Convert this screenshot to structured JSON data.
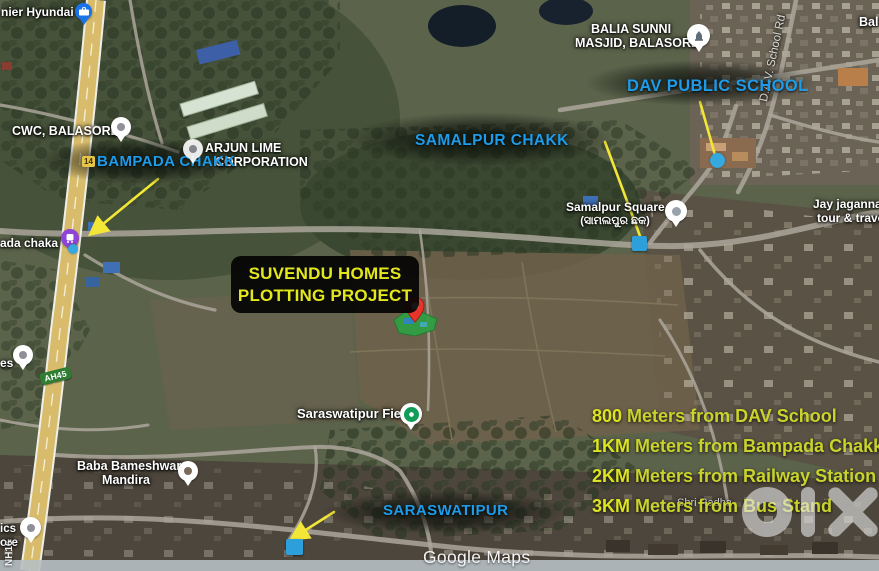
{
  "map": {
    "attribution": "Google Maps",
    "watermark": "olx"
  },
  "project_card": {
    "line1": "SUVENDU HOMES",
    "line2": "PLOTTING PROJECT"
  },
  "callouts": {
    "bampada": {
      "label": "BAMPADA CHAKK"
    },
    "samalpur": {
      "label": "SAMALPUR CHAKK"
    },
    "dav": {
      "label": "DAV PUBLIC SCHOOL"
    },
    "saraswatipur": {
      "label": "SARASWATIPUR"
    }
  },
  "distances": [
    {
      "value": "800",
      "text": " Meters from DAV School"
    },
    {
      "value": "1KM",
      "text": " Meters from Bampada Chakk"
    },
    {
      "value": "2KM",
      "text": " Meters from Railway Station"
    },
    {
      "value": "3KM",
      "text": " Meters from Bus Stand"
    }
  ],
  "map_labels": {
    "hyundai": "nier Hyundai",
    "balia1": "BALIA SUNNI",
    "balia2": "MASJID, BALASORE",
    "bal": "Bal",
    "cwc": "CWC, BALASORE",
    "arjun1": "ARJUN LIME",
    "arjun2": "CORPORATION",
    "chaka": "ada chaka",
    "square": "Samalpur Square",
    "square_odia": "(ସାମଲପୁର ଛକ)",
    "field": "Saraswatipur Field",
    "mandira1": "Baba Bameshwar",
    "mandira2": "Mandira",
    "jay1": "Jay jagannath",
    "jay2": "tour & travels",
    "dav_road": "D.A.V. School Rd",
    "shri": "Shri Radha",
    "es": "es",
    "ics1": "ics",
    "ics2": "ore"
  },
  "route_badges": {
    "ah": "AH45",
    "nh": "NH16",
    "sh": "14"
  },
  "colors": {
    "label_blue": "#1E9BE9",
    "title_yellow": "#E3E71C",
    "distance_yellow": "#C9D32B",
    "arrow_yellow": "#F2E637",
    "highway": "#D8BC6C",
    "plot_green": "#2FA043",
    "pin_red": "#E8352B"
  }
}
